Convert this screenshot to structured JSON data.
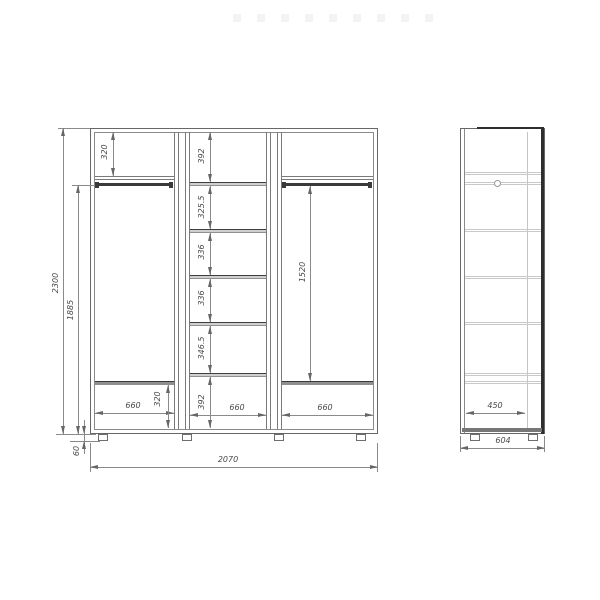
{
  "front_view": {
    "overall": {
      "height": "2300",
      "interior_height": "1885",
      "leg_height": "60",
      "width": "2070"
    },
    "left_section": {
      "top_shelf_height": "320",
      "bottom_width": "660",
      "bottom_compartment_height": "320"
    },
    "middle_section": {
      "compartments": [
        "392",
        "325.5",
        "336",
        "336",
        "346.5",
        "392"
      ],
      "bottom_width": "660"
    },
    "right_section": {
      "hanging_height": "1520",
      "bottom_width": "660"
    }
  },
  "side_view": {
    "interior_depth": "450",
    "overall_depth": "604"
  }
}
